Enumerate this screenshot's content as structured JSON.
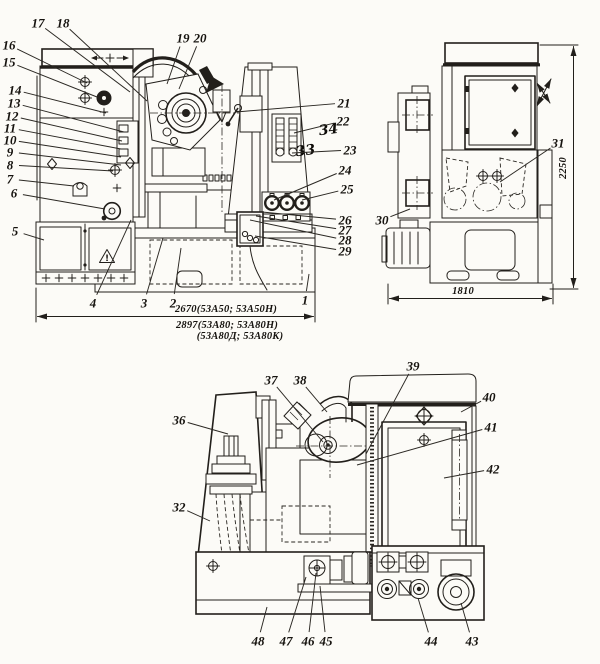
{
  "page": {
    "background": "#fcfbf7",
    "ink": "#221f1b"
  },
  "figure": {
    "description": "Three outline views of a gear-hobbing machine with numbered part callouts",
    "views": [
      {
        "id": "front",
        "name": "front elevation"
      },
      {
        "id": "side",
        "name": "right side elevation"
      },
      {
        "id": "rear",
        "name": "rear elevation"
      }
    ]
  },
  "callouts": [
    {
      "label": "1",
      "view": "front",
      "x": 305,
      "y": 300,
      "tx": 309,
      "ty": 274
    },
    {
      "label": "2",
      "view": "front",
      "x": 173,
      "y": 303,
      "tx": 181,
      "ty": 248
    },
    {
      "label": "3",
      "view": "front",
      "x": 144,
      "y": 303,
      "tx": 163,
      "ty": 238
    },
    {
      "label": "4",
      "view": "front",
      "x": 93,
      "y": 303,
      "tx": 131,
      "ty": 220
    },
    {
      "label": "5",
      "view": "front",
      "x": 15,
      "y": 231,
      "tx": 44,
      "ty": 240
    },
    {
      "label": "6",
      "view": "front",
      "x": 14,
      "y": 193,
      "tx": 105,
      "ty": 209
    },
    {
      "label": "7",
      "view": "front",
      "x": 10,
      "y": 179,
      "tx": 74,
      "ty": 186
    },
    {
      "label": "8",
      "view": "front",
      "x": 10,
      "y": 165,
      "tx": 113,
      "ty": 171
    },
    {
      "label": "9",
      "view": "front",
      "x": 10,
      "y": 152,
      "tx": 121,
      "ty": 165
    },
    {
      "label": "10",
      "view": "front",
      "x": 10,
      "y": 140,
      "tx": 121,
      "ty": 157
    },
    {
      "label": "11",
      "view": "front",
      "x": 10,
      "y": 128,
      "tx": 121,
      "ty": 149
    },
    {
      "label": "12",
      "view": "front",
      "x": 12,
      "y": 116,
      "tx": 122,
      "ty": 141
    },
    {
      "label": "13",
      "view": "front",
      "x": 14,
      "y": 103,
      "tx": 124,
      "ty": 132
    },
    {
      "label": "14",
      "view": "front",
      "x": 15,
      "y": 90,
      "tx": 106,
      "ty": 113
    },
    {
      "label": "15",
      "view": "front",
      "x": 9,
      "y": 62,
      "tx": 97,
      "ty": 97
    },
    {
      "label": "16",
      "view": "front",
      "x": 9,
      "y": 45,
      "tx": 87,
      "ty": 83
    },
    {
      "label": "17",
      "view": "front",
      "x": 38,
      "y": 23,
      "tx": 130,
      "ty": 92
    },
    {
      "label": "18",
      "view": "front",
      "x": 63,
      "y": 23,
      "tx": 147,
      "ty": 101
    },
    {
      "label": "19",
      "view": "front",
      "x": 183,
      "y": 38,
      "tx": 167,
      "ty": 84
    },
    {
      "label": "20",
      "view": "front",
      "x": 200,
      "y": 38,
      "tx": 179,
      "ty": 89
    },
    {
      "label": "21",
      "view": "front",
      "x": 344,
      "y": 103,
      "tx": 236,
      "ty": 112
    },
    {
      "label": "22",
      "view": "front",
      "x": 343,
      "y": 121,
      "tx": 294,
      "ty": 133
    },
    {
      "label": "23",
      "view": "front",
      "x": 350,
      "y": 150,
      "tx": 292,
      "ty": 153
    },
    {
      "label": "24",
      "view": "front",
      "x": 345,
      "y": 170,
      "tx": 274,
      "ty": 200
    },
    {
      "label": "25",
      "view": "front",
      "x": 347,
      "y": 189,
      "tx": 302,
      "ty": 200
    },
    {
      "label": "26",
      "view": "front",
      "x": 345,
      "y": 220,
      "tx": 262,
      "ty": 212
    },
    {
      "label": "27",
      "view": "front",
      "x": 345,
      "y": 230,
      "tx": 256,
      "ty": 216
    },
    {
      "label": "28",
      "view": "front",
      "x": 345,
      "y": 240,
      "tx": 250,
      "ty": 220
    },
    {
      "label": "29",
      "view": "front",
      "x": 345,
      "y": 251,
      "tx": 255,
      "ty": 236
    },
    {
      "label": "30",
      "view": "side",
      "x": 382,
      "y": 220,
      "tx": 410,
      "ty": 209
    },
    {
      "label": "31",
      "view": "side",
      "x": 558,
      "y": 143,
      "tx": 500,
      "ty": 182
    },
    {
      "label": "32",
      "view": "rear",
      "x": 179,
      "y": 507,
      "tx": 210,
      "ty": 521
    },
    {
      "label": "36",
      "view": "rear",
      "x": 179,
      "y": 420,
      "tx": 228,
      "ty": 434
    },
    {
      "label": "37",
      "view": "rear",
      "x": 271,
      "y": 380,
      "tx": 323,
      "ty": 442
    },
    {
      "label": "38",
      "view": "rear",
      "x": 300,
      "y": 380,
      "tx": 327,
      "ty": 412
    },
    {
      "label": "39",
      "view": "rear",
      "x": 413,
      "y": 366,
      "tx": 366,
      "ty": 454
    },
    {
      "label": "40",
      "view": "rear",
      "x": 489,
      "y": 397,
      "tx": 461,
      "ty": 412
    },
    {
      "label": "41",
      "view": "rear",
      "x": 491,
      "y": 427,
      "tx": 357,
      "ty": 465
    },
    {
      "label": "42",
      "view": "rear",
      "x": 493,
      "y": 469,
      "tx": 444,
      "ty": 478
    },
    {
      "label": "43",
      "view": "rear",
      "x": 472,
      "y": 641,
      "tx": 461,
      "ty": 603
    },
    {
      "label": "44",
      "view": "rear",
      "x": 431,
      "y": 641,
      "tx": 418,
      "ty": 598
    },
    {
      "label": "45",
      "view": "rear",
      "x": 326,
      "y": 641,
      "tx": 320,
      "ty": 586
    },
    {
      "label": "46",
      "view": "rear",
      "x": 308,
      "y": 641,
      "tx": 316,
      "ty": 573
    },
    {
      "label": "47",
      "view": "rear",
      "x": 286,
      "y": 641,
      "tx": 306,
      "ty": 577
    },
    {
      "label": "48",
      "view": "rear",
      "x": 258,
      "y": 641,
      "tx": 267,
      "ty": 607
    }
  ],
  "dimensions": [
    {
      "id": "front-width",
      "text": "2670(53А50; 53А50Н)",
      "x": 226,
      "y": 312,
      "rotate": 0
    },
    {
      "id": "front-width-alt",
      "text": "2897(53А80; 53А80Н)",
      "x": 227,
      "y": 328,
      "rotate": 0
    },
    {
      "id": "front-width-alt2",
      "text": "(53А80Д; 53А80К)",
      "x": 240,
      "y": 339,
      "rotate": 0
    },
    {
      "id": "side-depth",
      "text": "1810",
      "x": 463,
      "y": 294,
      "rotate": 0
    },
    {
      "id": "side-height",
      "text": "2250",
      "x": 566,
      "y": 168,
      "rotate": -90
    }
  ],
  "handwritten": [
    {
      "text": "34",
      "x": 329,
      "y": 134,
      "rotate": -7
    },
    {
      "text": "33",
      "x": 306,
      "y": 155,
      "rotate": -7
    }
  ],
  "symbols": {
    "warning_mark": "!"
  }
}
